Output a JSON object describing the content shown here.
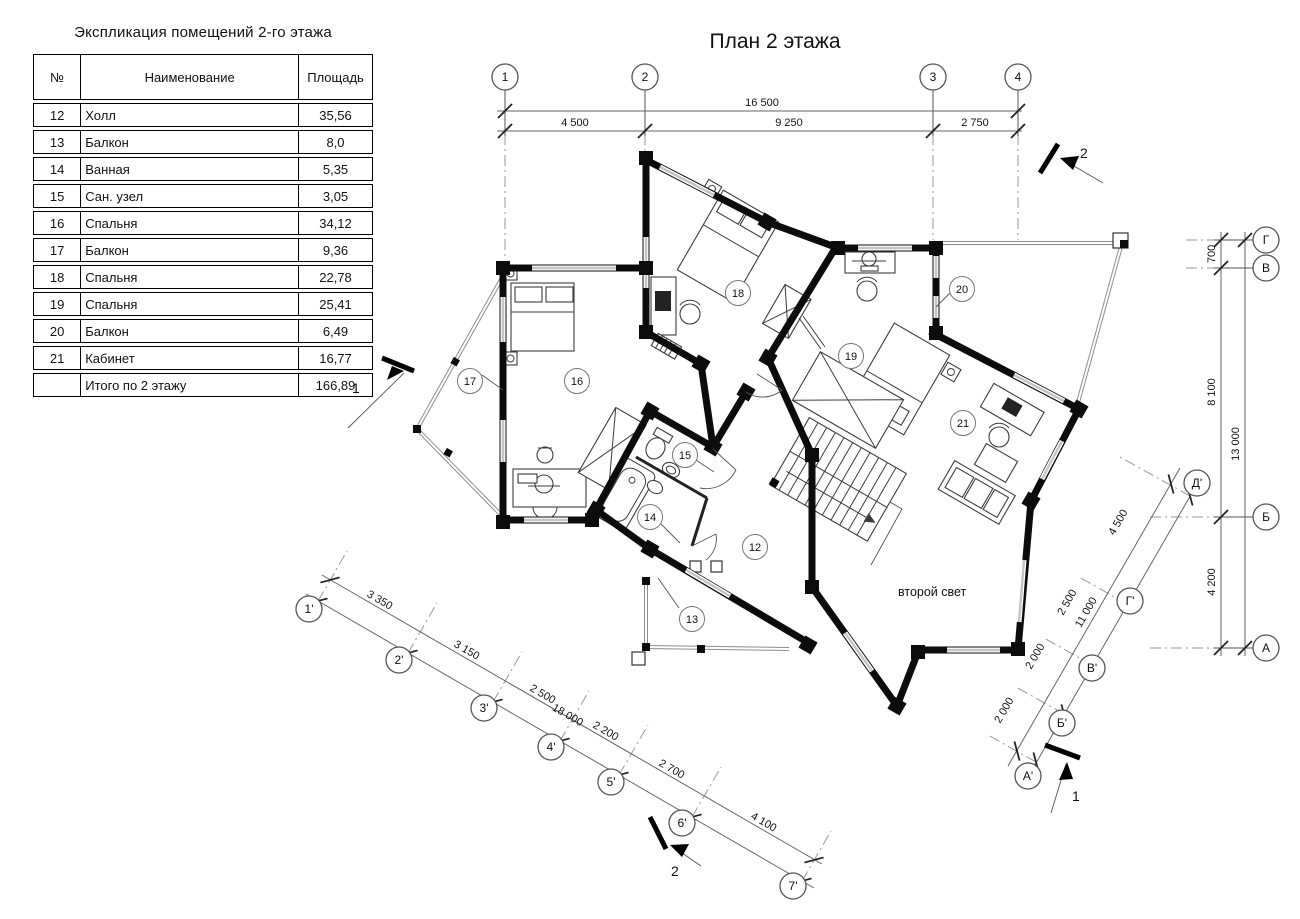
{
  "explication": {
    "title": "Экспликация помещений 2-го этажа",
    "headers": [
      "№",
      "Наименование",
      "Площадь"
    ],
    "rows": [
      [
        "12",
        "Холл",
        "35,56"
      ],
      [
        "13",
        "Балкон",
        "8,0"
      ],
      [
        "14",
        "Ванная",
        "5,35"
      ],
      [
        "15",
        "Сан. узел",
        "3,05"
      ],
      [
        "16",
        "Спальня",
        "34,12"
      ],
      [
        "17",
        "Балкон",
        "9,36"
      ],
      [
        "18",
        "Спальня",
        "22,78"
      ],
      [
        "19",
        "Спальня",
        "25,41"
      ],
      [
        "20",
        "Балкон",
        "6,49"
      ],
      [
        "21",
        "Кабинет",
        "16,77"
      ],
      [
        "",
        "Итого по 2 этажу",
        "166,89"
      ]
    ]
  },
  "plan": {
    "title": "План 2 этажа",
    "note": "второй свет",
    "axes": {
      "top": [
        "1",
        "2",
        "3",
        "4"
      ],
      "right": [
        "Г",
        "В",
        "Б",
        "А"
      ],
      "diag_right": [
        "Д'",
        "Г'",
        "В'",
        "Б'",
        "А'"
      ],
      "diag_bottom": [
        "1'",
        "2'",
        "3'",
        "4'",
        "5'",
        "6'",
        "7'"
      ]
    },
    "dims": {
      "top_total": "16 500",
      "top": [
        "4 500",
        "9 250",
        "2 750"
      ],
      "right_total": "13 000",
      "right": [
        "700",
        "8 100",
        "4 200"
      ],
      "diag_bottom_total": "18 000",
      "diag_bottom": [
        "3 350",
        "3 150",
        "2 500",
        "2 200",
        "2 700",
        "4 100"
      ],
      "diag_right_total": "11 000",
      "diag_right": [
        "2 000",
        "2 000",
        "2 500",
        "4 500"
      ]
    },
    "rooms": [
      "12",
      "13",
      "14",
      "15",
      "16",
      "17",
      "18",
      "19",
      "20",
      "21"
    ],
    "sections": {
      "left": "1",
      "top_right": "2",
      "bottom": "2",
      "bottom_right": "1"
    }
  }
}
